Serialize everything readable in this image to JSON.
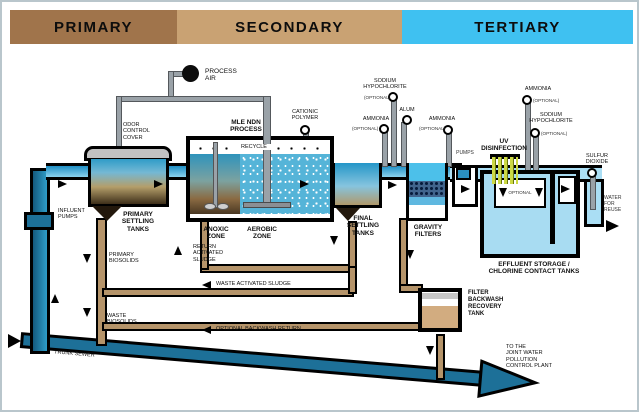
{
  "title": "Wastewater treatment plant process diagram",
  "header": {
    "primary": "PRIMARY",
    "secondary": "SECONDARY",
    "tertiary": "TERTIARY"
  },
  "labels": {
    "process_air": "PROCESS\nAIR",
    "odor_control_cover": "ODOR\nCONTROL\nCOVER",
    "influent_pumps": "INFLUENT\nPUMPS",
    "primary_settling_tanks": "PRIMARY\nSETTLING\nTANKS",
    "primary_biosolids": "PRIMARY\nBIOSOLIDS",
    "waste_biosolids": "WASTE\nBIOSOLIDS",
    "trunk_sewer": "TRUNK SEWER",
    "mle_ndn_process": "MLE NDN\nPROCESS",
    "recycle": "RECYCLE",
    "anoxic_zone": "ANOXIC\nZONE",
    "aerobic_zone": "AEROBIC\nZONE",
    "return_activated_sludge": "RETURN\nACTIVATED\nSLUDGE",
    "waste_activated_sludge": "WASTE ACTIVATED SLUDGE",
    "optional_backwash_return": "OPTIONAL BACKWASH RETURN",
    "final_settling_tanks": "FINAL\nSETTLING\nTANKS",
    "gravity_filters": "GRAVITY\nFILTERS",
    "pumps": "PUMPS",
    "uv_disinfection": "UV\nDISINFECTION",
    "optional": "OPTIONAL",
    "effluent_storage": "EFFLUENT STORAGE /\nCHLORINE CONTACT TANKS",
    "water_for_reuse": "WATER\nFOR\nREUSE",
    "filter_backwash_recovery_tank": "FILTER\nBACKWASH\nRECOVERY\nTANK",
    "to_joint_plant": "TO THE\nJOINT WATER\nPOLLUTION\nCONTROL PLANT"
  },
  "chemicals": {
    "ammonia": "AMMONIA",
    "sodium_hypochlorite": "SODIUM\nHYPOCHLORITE",
    "alum": "ALUM",
    "cationic_polymer": "CATIONIC\nPOLYMER",
    "sulfur_dioxide": "SULFUR\nDIOXIDE",
    "optional_tag": "(OPTIONAL)"
  },
  "colors": {
    "primary_header": "#a0744b",
    "secondary_header": "#c9a273",
    "tertiary_header": "#3fc1f1",
    "channel_water": "#2795c8",
    "tertiary_water": "#aadef4",
    "sludge_pipe": "#b5946a",
    "sewer_pipe": "#1d7098",
    "uv_lamp": "#cdd944",
    "filter_media": "#41648c"
  }
}
